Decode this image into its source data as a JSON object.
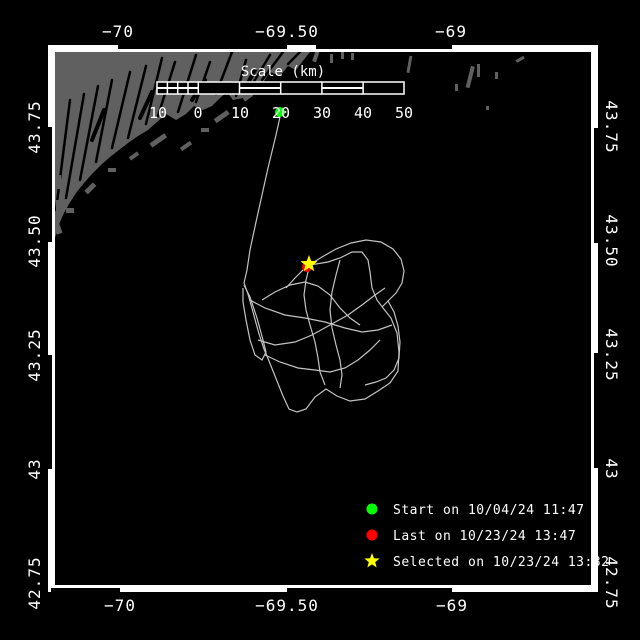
{
  "window": {
    "description": "Drifter track map viewer"
  },
  "axes": {
    "top": [
      "−70",
      "−69.50",
      "−69"
    ],
    "bottom": [
      "−70",
      "−69.50",
      "−69"
    ],
    "left": [
      "43.75",
      "43.50",
      "43.25",
      "43",
      "42.75"
    ],
    "right": [
      "43.75",
      "43.50",
      "43.25",
      "43",
      "42.75"
    ]
  },
  "scale_bar": {
    "title": "Scale (km)",
    "tick_labels": [
      "10",
      "0",
      "10",
      "20",
      "30",
      "40",
      "50"
    ]
  },
  "legend": {
    "items": [
      {
        "marker": "green-circle",
        "label": "Start on 10/04/24 11:47"
      },
      {
        "marker": "red-circle",
        "label": "Last on 10/23/24 13:47"
      },
      {
        "marker": "yellow-star",
        "label": "Selected on 10/23/24 13:32"
      }
    ]
  },
  "colors": {
    "background": "#000000",
    "land": "#606060",
    "track": "#c3c3c3",
    "frame": "#ffffff",
    "start_marker": "#00ff00",
    "last_marker": "#ff0000",
    "selected_marker": "#ffff00",
    "text": "#ffffff"
  }
}
